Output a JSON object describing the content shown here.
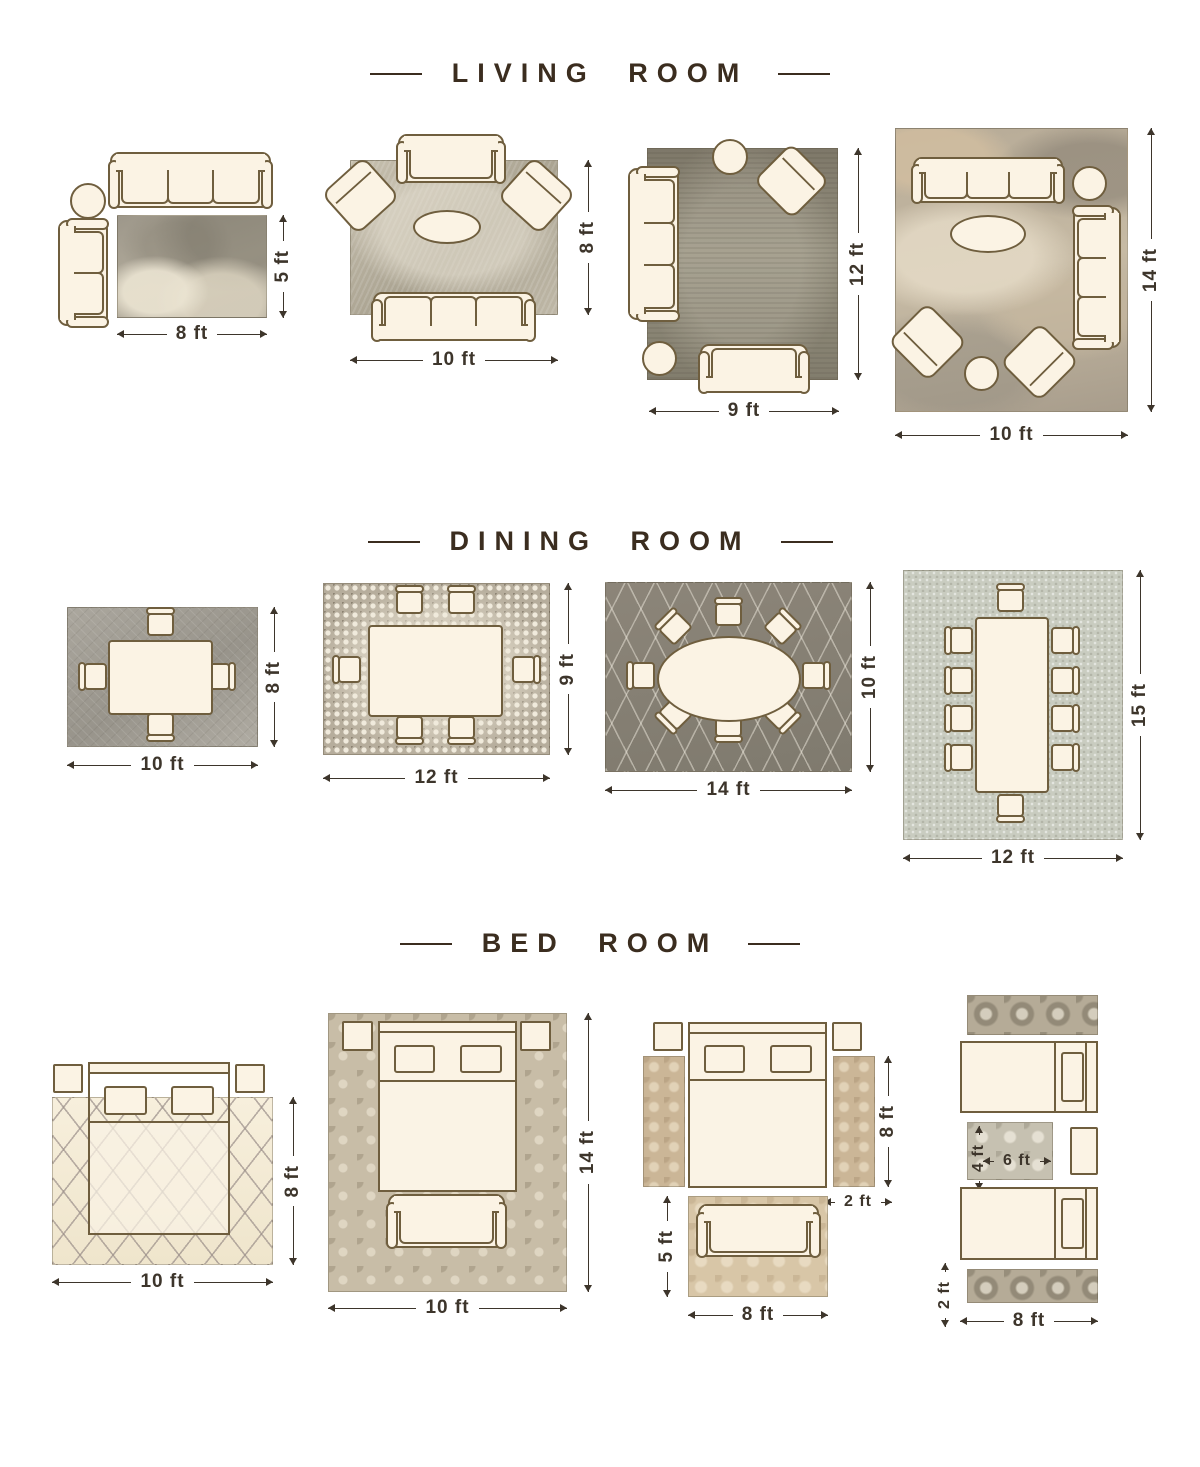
{
  "colors": {
    "--bg": "#ffffff",
    "--heading": "#3b2d1f",
    "--dim": "#3d352b",
    "--line": "#6f5e3e",
    "--fill": "#fbf3e4"
  },
  "sections": [
    {
      "title": "LIVING ROOM",
      "layouts": [
        {
          "rug_size": "8 x 5 ft",
          "width_label": "8 ft",
          "height_label": "5 ft",
          "furniture": [
            "sofa",
            "loveseat",
            "side-table"
          ]
        },
        {
          "rug_size": "10 x 8 ft",
          "width_label": "10 ft",
          "height_label": "8 ft",
          "furniture": [
            "loveseat",
            "armchair",
            "armchair",
            "coffee-table",
            "sofa"
          ]
        },
        {
          "rug_size": "9 x 12 ft",
          "width_label": "9 ft",
          "height_label": "12 ft",
          "furniture": [
            "side-table",
            "armchair",
            "sofa",
            "side-table",
            "loveseat"
          ]
        },
        {
          "rug_size": "10 x 14 ft",
          "width_label": "10 ft",
          "height_label": "14 ft",
          "furniture": [
            "sofa",
            "side-table",
            "sofa",
            "coffee-table",
            "armchair",
            "armchair",
            "side-table"
          ]
        }
      ]
    },
    {
      "title": "DINING ROOM",
      "layouts": [
        {
          "rug_size": "10 x 8 ft",
          "width_label": "10 ft",
          "height_label": "8 ft",
          "furniture": [
            "dining-table",
            "4-chairs"
          ]
        },
        {
          "rug_size": "12 x 9 ft",
          "width_label": "12 ft",
          "height_label": "9 ft",
          "furniture": [
            "dining-table",
            "6-chairs"
          ]
        },
        {
          "rug_size": "14 x 10 ft",
          "width_label": "14 ft",
          "height_label": "10 ft",
          "furniture": [
            "oval-dining-table",
            "8-chairs"
          ]
        },
        {
          "rug_size": "12 x 15 ft",
          "width_label": "12 ft",
          "height_label": "15 ft",
          "furniture": [
            "dining-table",
            "10-chairs"
          ]
        }
      ]
    },
    {
      "title": "BED ROOM",
      "layouts": [
        {
          "rug_size": "10 x 8 ft",
          "width_label": "10 ft",
          "height_label": "8 ft",
          "furniture": [
            "bed",
            "nightstand",
            "nightstand"
          ]
        },
        {
          "rug_size": "10 x 14 ft",
          "width_label": "10 ft",
          "height_label": "14 ft",
          "furniture": [
            "bed",
            "nightstand",
            "nightstand",
            "bench"
          ]
        },
        {
          "rug_size": "8 x 5 ft + 2 x 8 ft runners",
          "width_label": "8 ft",
          "height_label": "5 ft",
          "runner_length_label": "8 ft",
          "runner_width_label": "2 ft",
          "furniture": [
            "bed",
            "nightstand",
            "nightstand",
            "runner-rug",
            "runner-rug",
            "loveseat"
          ]
        },
        {
          "rug_size": "4 x 6 ft + 2 x 8 ft runners",
          "width_label": "8 ft",
          "runner_width_label": "2 ft",
          "mid_rug_width_label": "6 ft",
          "mid_rug_height_label": "4 ft",
          "furniture": [
            "runner-rug",
            "twin-bed",
            "twin-bed",
            "nightstand",
            "runner-rug"
          ]
        }
      ]
    }
  ]
}
